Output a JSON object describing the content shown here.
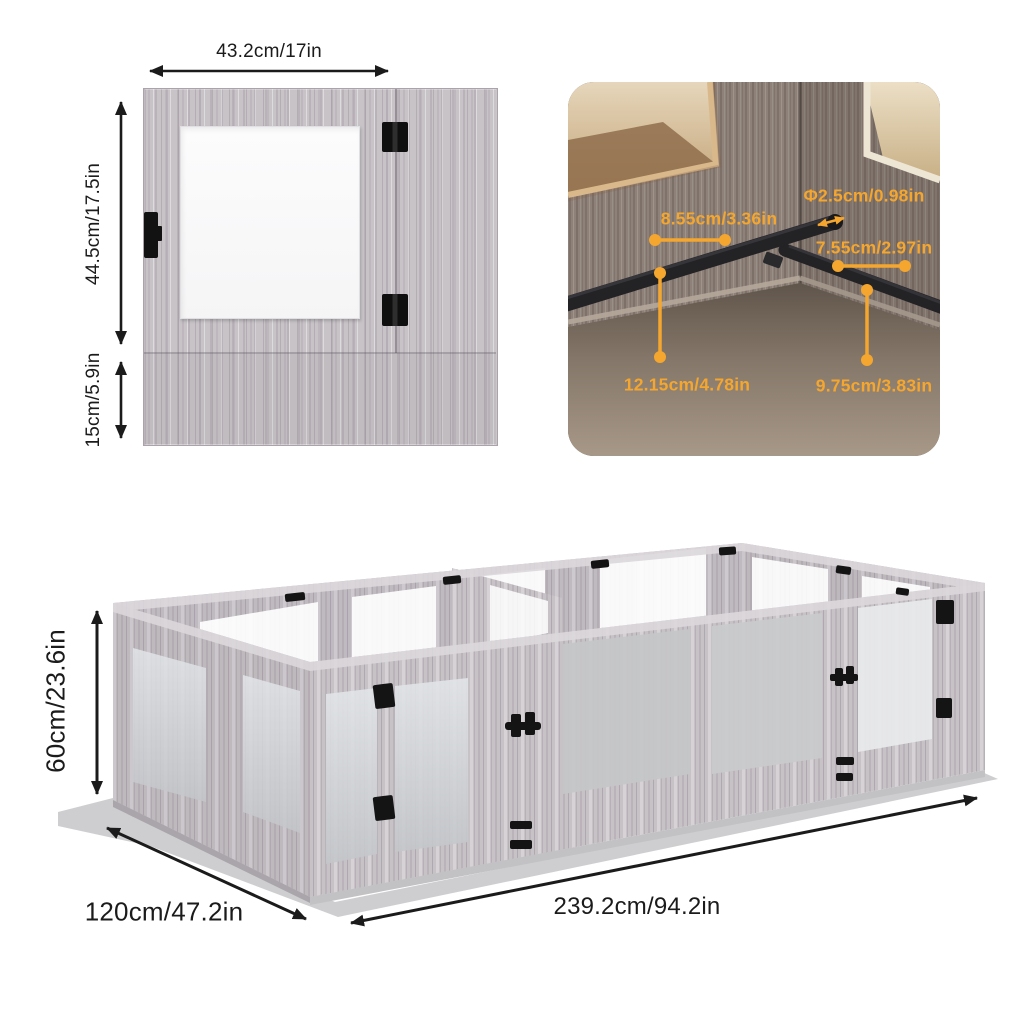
{
  "page": {
    "background": "#ffffff"
  },
  "colors": {
    "accent_orange": "#F4A62E",
    "text_black": "#1b1b1b",
    "wood_light_gray": "#c7c3c7",
    "window_white": "#fbfbfc",
    "floor_gray": "#bcbdbf",
    "photo_wall_taupe": "#8d8179",
    "photo_opening_tan": "#d2ba92",
    "bar_black": "#232225"
  },
  "panel_diagram": {
    "width_label": "43.2cm/17in",
    "upper_height_label": "44.5cm/17.5in",
    "lower_height_label": "15cm/5.9in"
  },
  "detail_photo": {
    "diameter_label": "Φ2.5cm/0.98in",
    "back_bar_length_label": "8.55cm/3.36in",
    "right_bar_length_label": "7.55cm/2.97in",
    "back_bar_height_label": "12.15cm/4.78in",
    "right_bar_height_label": "9.75cm/3.83in"
  },
  "assembled_view": {
    "height_label": "60cm/23.6in",
    "depth_label": "120cm/47.2in",
    "length_label": "239.2cm/94.2in"
  }
}
